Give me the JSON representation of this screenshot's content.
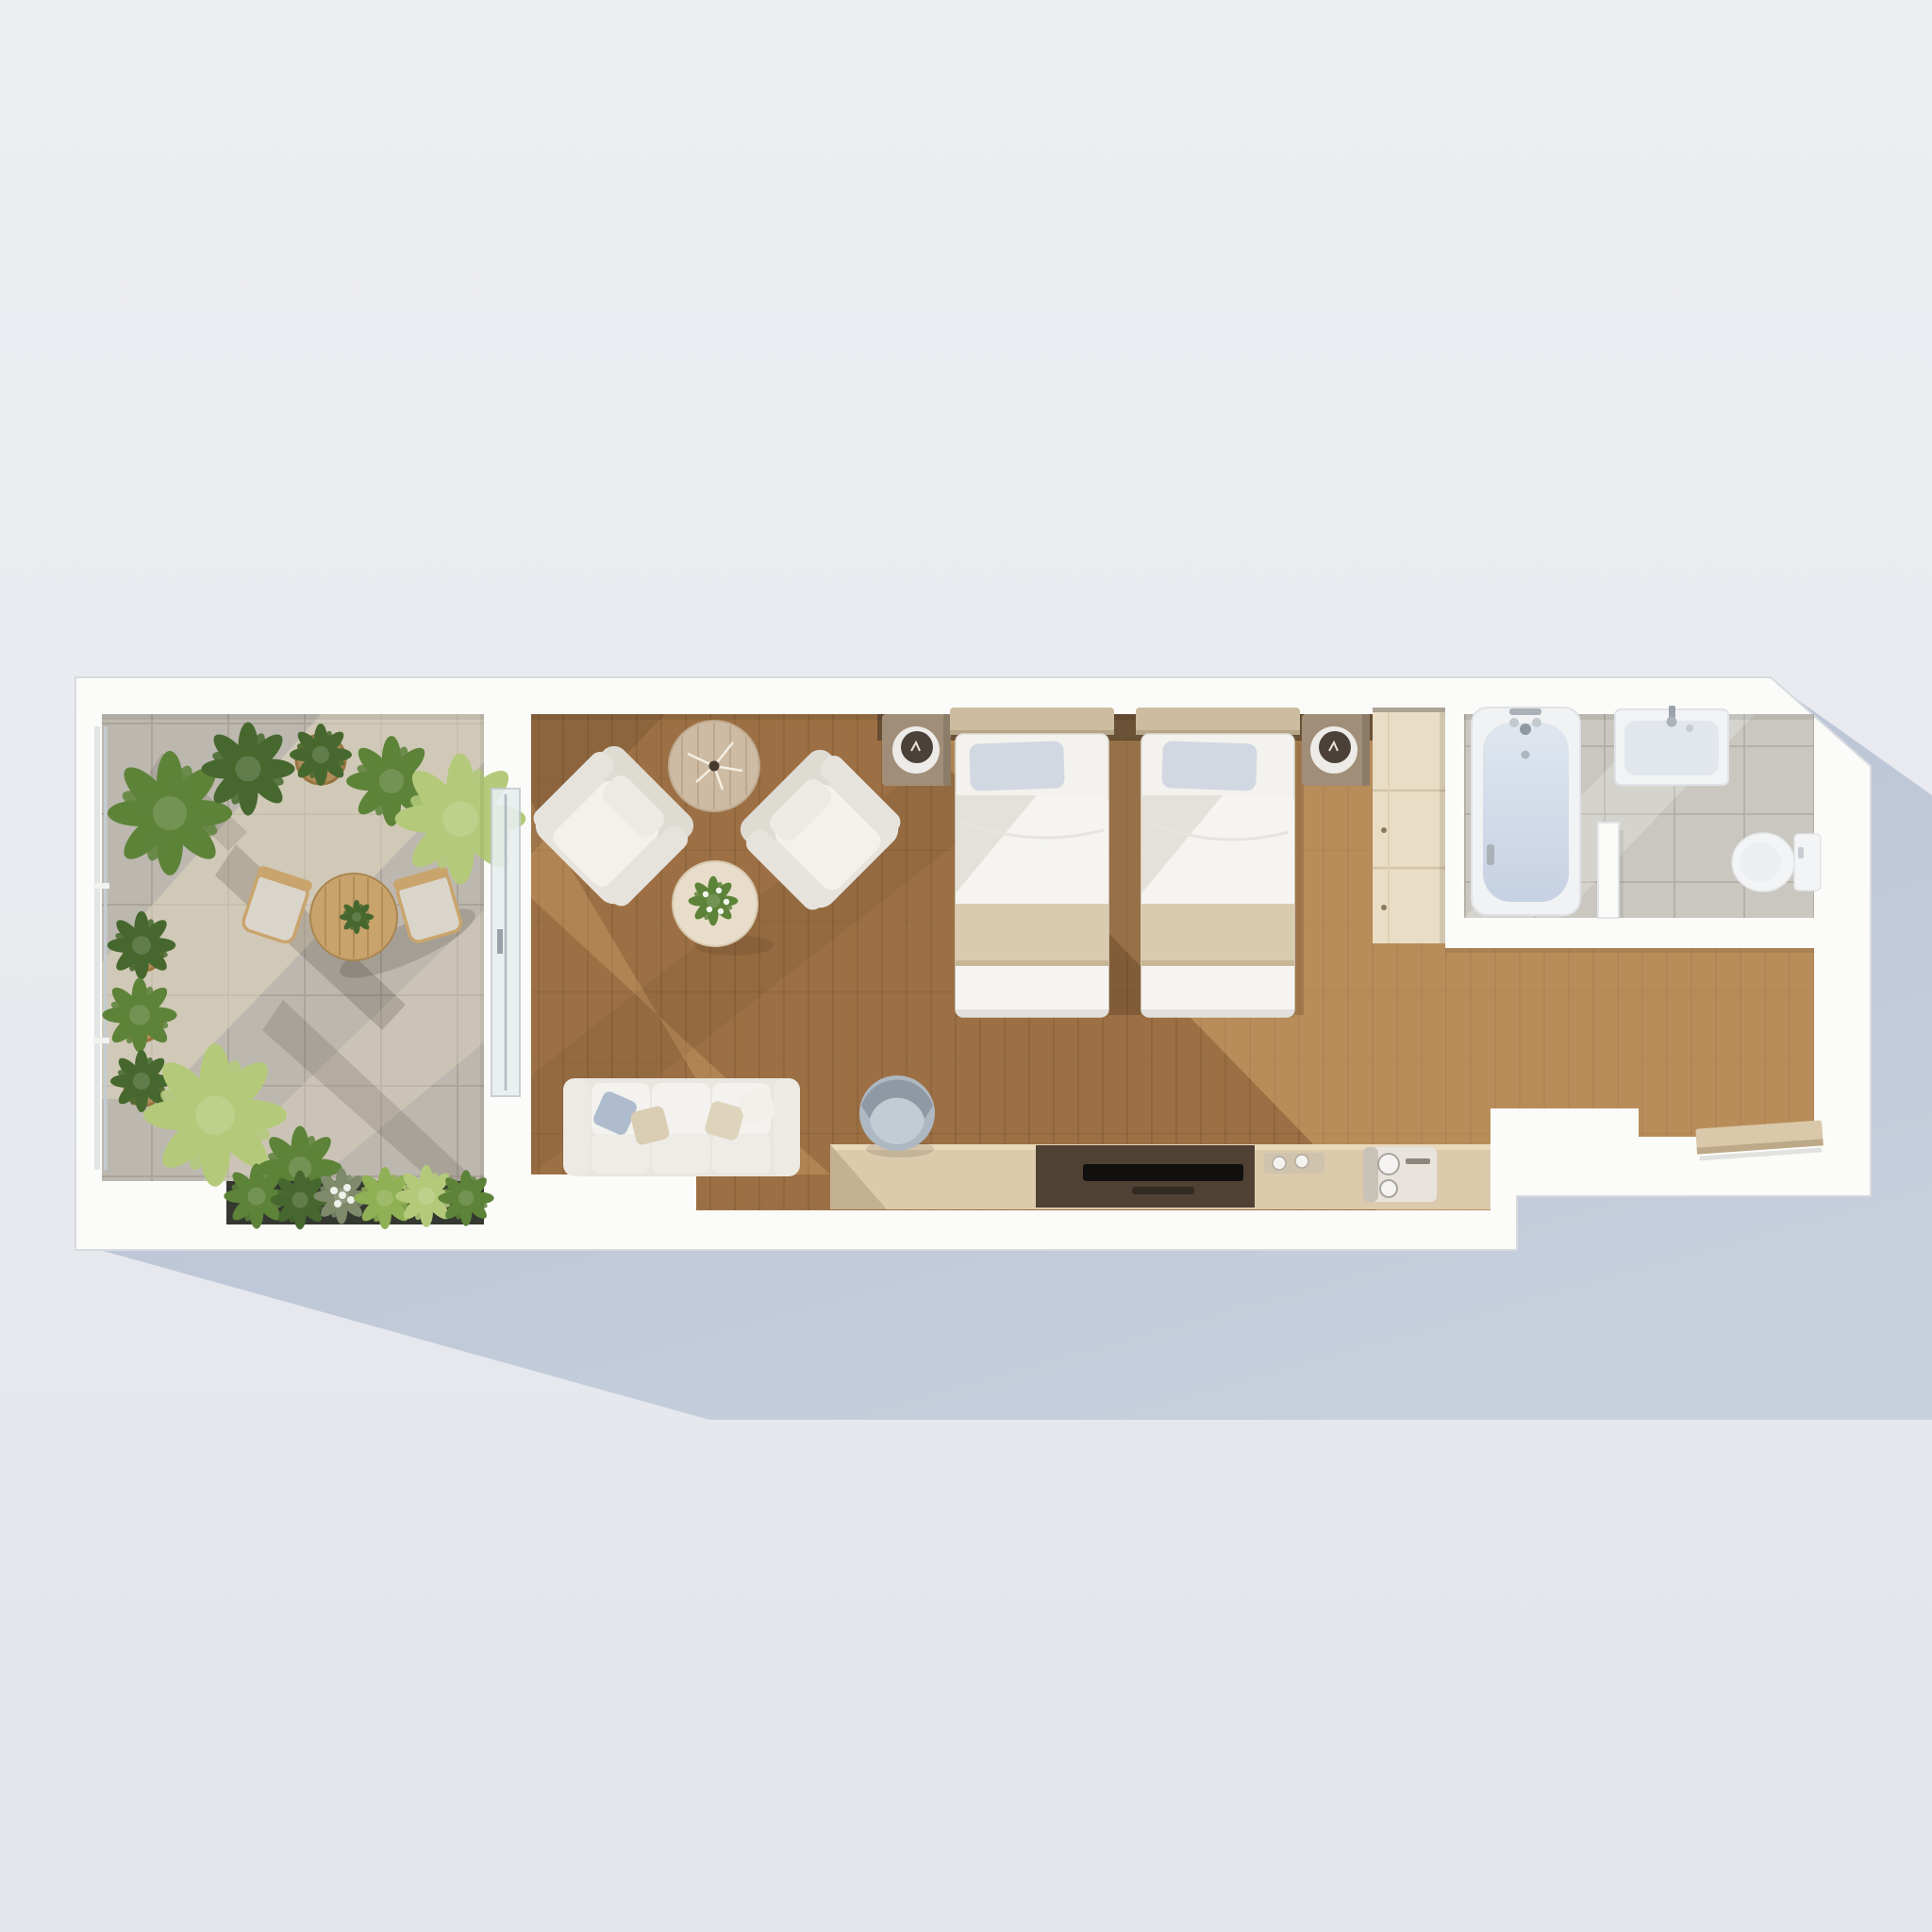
{
  "scene": {
    "description": "Top-down 3D architectural render of a narrow studio hotel suite with terrace",
    "view": "top-down",
    "shadow_direction": "lower-right"
  },
  "colors": {
    "bg_top": "#edeef2",
    "bg_bottom": "#e2e5eb",
    "shadow_near": "#b2bdd0",
    "shadow_far": "#c7d0dd",
    "wall": "#fbfbf9",
    "wall_edge": "#d7dade",
    "terrace_tile": "#bdb8af",
    "terrace_tile_line": "#8d867a",
    "terrace_sun": "#e6d9c2",
    "wood_base": "#9c7044",
    "wood_sun": "#e2b478",
    "wood_line": "#5e3d22",
    "bath_tile": "#cac7c0",
    "bath_tile_line": "#9a958b",
    "tub_light": "#dfe6ef",
    "tub_water": "#c6d1e3",
    "fixture_white": "#f3f4f5",
    "linen": "#f3f2ee",
    "blanket": "#d9cbb0",
    "pillow": "#d2d8e2",
    "headboard": "#cdbc9f",
    "nightstand": "#a08e78",
    "lamp_dark": "#4c4138",
    "wardrobe": "#e9ddc5",
    "console": "#dbcaac",
    "console_recess": "#4f4134",
    "tv": "#12100e",
    "sofa": "#efeeea",
    "chair_gray": "#aeb8c2",
    "table_wood": "#c9a36c",
    "side_table": "#cdbba4",
    "coffee_table": "#e8ddca",
    "plant_dark": "#46682e",
    "plant_mid": "#5d8339",
    "plant_light": "#8fb054",
    "plant_pale": "#b4ca7a",
    "pot": "#b28c5a",
    "planter": "#343830",
    "glass": "#cfd9de"
  },
  "rooms": [
    {
      "id": "terrace",
      "name": "Terrace with plants",
      "floor": "grey stone tiles",
      "furniture": [
        "round bistro table",
        "terrace chair left",
        "terrace chair right",
        "potted plants row",
        "side pots",
        "large palm",
        "planter box with plants",
        "glass facade",
        "sliding glass door"
      ]
    },
    {
      "id": "lounge",
      "name": "Lounge area",
      "floor": "walnut plank flooring",
      "furniture": [
        "round side table with dried sprigs",
        "armchair left",
        "armchair right",
        "round coffee table with flowers",
        "three-seat sofa with cushions"
      ]
    },
    {
      "id": "bedroom",
      "name": "Twin bedroom",
      "floor": "walnut plank flooring",
      "furniture": [
        "nightstand with lamp",
        "twin bed left",
        "twin bed right",
        "nightstand with lamp",
        "wardrobe"
      ]
    },
    {
      "id": "bathroom",
      "name": "Bathroom",
      "floor": "grey ceramic tiles",
      "furniture": [
        "bathtub with faucet",
        "washbasin with faucet",
        "partition screen",
        "toilet"
      ]
    },
    {
      "id": "media-wall",
      "name": "Desk and media console",
      "furniture": [
        "desk chair",
        "long console desk",
        "TV recess with television",
        "tray with cups",
        "coffee machine"
      ]
    },
    {
      "id": "entry",
      "name": "Entry hallway",
      "floor": "oak plank flooring",
      "furniture": [
        "luggage bench"
      ]
    }
  ]
}
